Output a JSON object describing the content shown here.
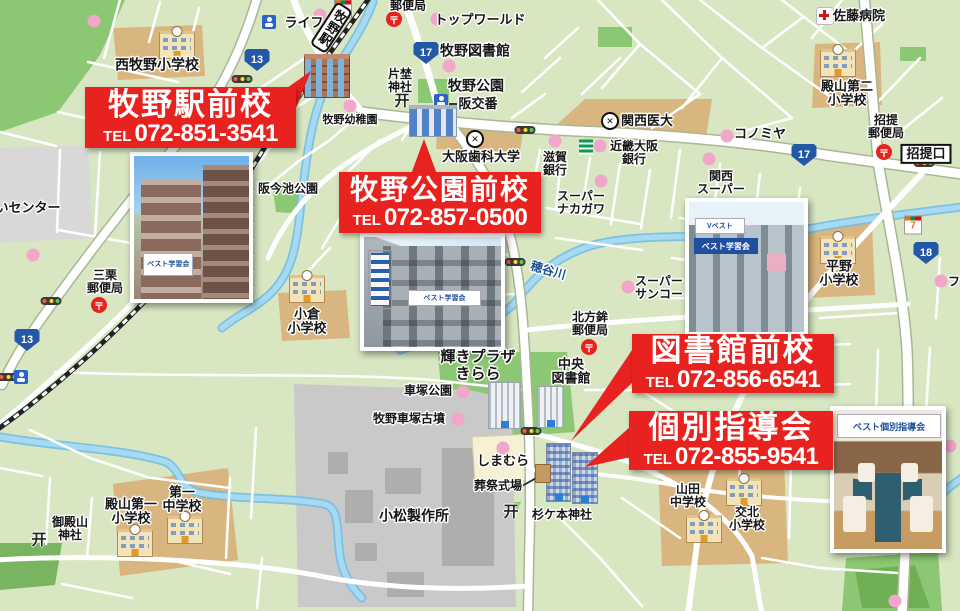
{
  "colors": {
    "banner_red": "#e8231f",
    "land": "#d8e7c2",
    "park": "#8cc873",
    "water": "#a6daf2",
    "tan": "#d9b57f",
    "factory": "#c9c9c9",
    "pink_dot": "#f2a6ca",
    "shield_blue": "#2358a7"
  },
  "banners": [
    {
      "title": "牧野駅前校",
      "tel_label": "TEL",
      "tel": "072-851-3541"
    },
    {
      "title": "牧野公園前校",
      "tel_label": "TEL",
      "tel": "072-857-0500"
    },
    {
      "title": "図書館前校",
      "tel_label": "TEL",
      "tel": "072-856-6541"
    },
    {
      "title": "個別指導会",
      "tel_label": "TEL",
      "tel": "072-855-9541"
    }
  ],
  "photos": {
    "p1_sign": "ベスト学習会",
    "p3_roof": "Vベスト",
    "p3_sign": "ベスト学習会",
    "p4_sign": "ベスト個別指導会"
  },
  "station_sign": "牧野駅",
  "icon_glyphs": {
    "post": "〒",
    "torii": "开",
    "univ": "✕",
    "seven": "7"
  },
  "route_shields": [
    {
      "n": "13",
      "x": 257,
      "y": 60
    },
    {
      "n": "13",
      "x": 27,
      "y": 340
    },
    {
      "n": "17",
      "x": 426,
      "y": 53
    },
    {
      "n": "17",
      "x": 804,
      "y": 155
    },
    {
      "n": "18",
      "x": 926,
      "y": 253
    }
  ],
  "map_labels": [
    {
      "t": "西牧野小学校",
      "x": 157,
      "y": 65,
      "s": 14
    },
    {
      "t": "ライフ",
      "x": 304,
      "y": 23,
      "s": 13
    },
    {
      "t": "郵便局",
      "x": 408,
      "y": 6,
      "s": 12
    },
    {
      "t": "トップワールド",
      "x": 480,
      "y": 20,
      "s": 13
    },
    {
      "t": "牧野図書館",
      "x": 475,
      "y": 51,
      "s": 14
    },
    {
      "t": "片埜\n神社",
      "x": 400,
      "y": 81,
      "s": 12
    },
    {
      "t": "牧野公園",
      "x": 476,
      "y": 86,
      "s": 14
    },
    {
      "t": "阪交番",
      "x": 478,
      "y": 104,
      "s": 13
    },
    {
      "t": "牧野幼稚園",
      "x": 350,
      "y": 120,
      "s": 11
    },
    {
      "t": "大阪歯科大学",
      "x": 481,
      "y": 157,
      "s": 13
    },
    {
      "t": "滋賀\n銀行",
      "x": 555,
      "y": 164,
      "s": 12
    },
    {
      "t": "近畿大阪\n銀行",
      "x": 634,
      "y": 153,
      "s": 12
    },
    {
      "t": "関西医大",
      "x": 647,
      "y": 121,
      "s": 13
    },
    {
      "t": "コノミヤ",
      "x": 760,
      "y": 134,
      "s": 13
    },
    {
      "t": "関西\nスーパー",
      "x": 721,
      "y": 183,
      "s": 12
    },
    {
      "t": "佐藤病院",
      "x": 859,
      "y": 16,
      "s": 13
    },
    {
      "t": "殿山第二\n小学校",
      "x": 847,
      "y": 94,
      "s": 13
    },
    {
      "t": "招提\n郵便局",
      "x": 886,
      "y": 127,
      "s": 12
    },
    {
      "t": "スーパー\nナカガワ",
      "x": 581,
      "y": 203,
      "s": 12
    },
    {
      "t": "穂谷川",
      "x": 548,
      "y": 271,
      "s": 12,
      "r": 16,
      "c": "#1c4f94"
    },
    {
      "t": "スーパー\nサンコー",
      "x": 659,
      "y": 288,
      "s": 12
    },
    {
      "t": "平野\n小学校",
      "x": 839,
      "y": 274,
      "s": 13
    },
    {
      "t": "北方鉾\n郵便局",
      "x": 590,
      "y": 324,
      "s": 12
    },
    {
      "t": "三栗\n郵便局",
      "x": 105,
      "y": 282,
      "s": 12
    },
    {
      "t": "いセンター",
      "x": 28,
      "y": 208,
      "s": 13
    },
    {
      "t": "阪今池公園",
      "x": 288,
      "y": 189,
      "s": 12
    },
    {
      "t": "小倉\n小学校",
      "x": 307,
      "y": 322,
      "s": 13
    },
    {
      "t": "輝きプラザ\nきらら",
      "x": 478,
      "y": 366,
      "s": 15
    },
    {
      "t": "中央\n図書館",
      "x": 571,
      "y": 372,
      "s": 13
    },
    {
      "t": "車塚公園",
      "x": 428,
      "y": 391,
      "s": 12
    },
    {
      "t": "牧野車塚古墳",
      "x": 409,
      "y": 419,
      "s": 12
    },
    {
      "t": "しまむら",
      "x": 503,
      "y": 461,
      "s": 13
    },
    {
      "t": "葬祭式場",
      "x": 498,
      "y": 486,
      "s": 12
    },
    {
      "t": "小松製作所",
      "x": 414,
      "y": 516,
      "s": 14
    },
    {
      "t": "殿山第一\n小学校",
      "x": 131,
      "y": 512,
      "s": 13
    },
    {
      "t": "第一\n中学校",
      "x": 182,
      "y": 500,
      "s": 13
    },
    {
      "t": "御殿山\n神社",
      "x": 70,
      "y": 529,
      "s": 12
    },
    {
      "t": "山田\n中学校",
      "x": 688,
      "y": 496,
      "s": 12
    },
    {
      "t": "交北\n小学校",
      "x": 747,
      "y": 519,
      "s": 12
    },
    {
      "t": "杉ケ本神社",
      "x": 562,
      "y": 515,
      "s": 12
    },
    {
      "t": "フ",
      "x": 954,
      "y": 282,
      "s": 12
    },
    {
      "t": "招提口",
      "x": 926,
      "y": 154,
      "s": 13,
      "box": true
    }
  ],
  "icons": {
    "pink_dots": [
      [
        94,
        21
      ],
      [
        320,
        15
      ],
      [
        437,
        19
      ],
      [
        449,
        66
      ],
      [
        350,
        106
      ],
      [
        555,
        141
      ],
      [
        600,
        146
      ],
      [
        727,
        136
      ],
      [
        709,
        159
      ],
      [
        601,
        181
      ],
      [
        628,
        287
      ],
      [
        941,
        281
      ],
      [
        33,
        255
      ],
      [
        463,
        392
      ],
      [
        458,
        419
      ],
      [
        503,
        448
      ],
      [
        950,
        446
      ],
      [
        895,
        601
      ]
    ],
    "traffic_lights": [
      [
        242,
        79
      ],
      [
        525,
        130
      ],
      [
        924,
        163
      ],
      [
        51,
        301
      ],
      [
        8,
        377
      ],
      [
        515,
        262
      ],
      [
        531,
        431
      ]
    ],
    "post_offices": [
      [
        394,
        19
      ],
      [
        884,
        152
      ],
      [
        99,
        305
      ],
      [
        589,
        347
      ]
    ],
    "seven_elevens": [
      [
        343,
        9
      ],
      [
        913,
        225
      ]
    ],
    "police_boxes": [
      [
        269,
        22
      ],
      [
        441,
        101
      ],
      [
        21,
        377
      ]
    ],
    "hospitals": [
      [
        825,
        16
      ]
    ],
    "university_marks": [
      [
        475,
        139
      ],
      [
        610,
        121
      ]
    ],
    "banks": [
      [
        586,
        147
      ]
    ],
    "torii": [
      [
        402,
        100
      ],
      [
        39,
        539
      ],
      [
        511,
        511
      ]
    ],
    "school_buildings": [
      [
        177,
        45
      ],
      [
        838,
        63
      ],
      [
        838,
        250
      ],
      [
        307,
        289
      ],
      [
        135,
        543
      ],
      [
        185,
        530
      ],
      [
        704,
        529
      ],
      [
        744,
        492
      ]
    ]
  }
}
